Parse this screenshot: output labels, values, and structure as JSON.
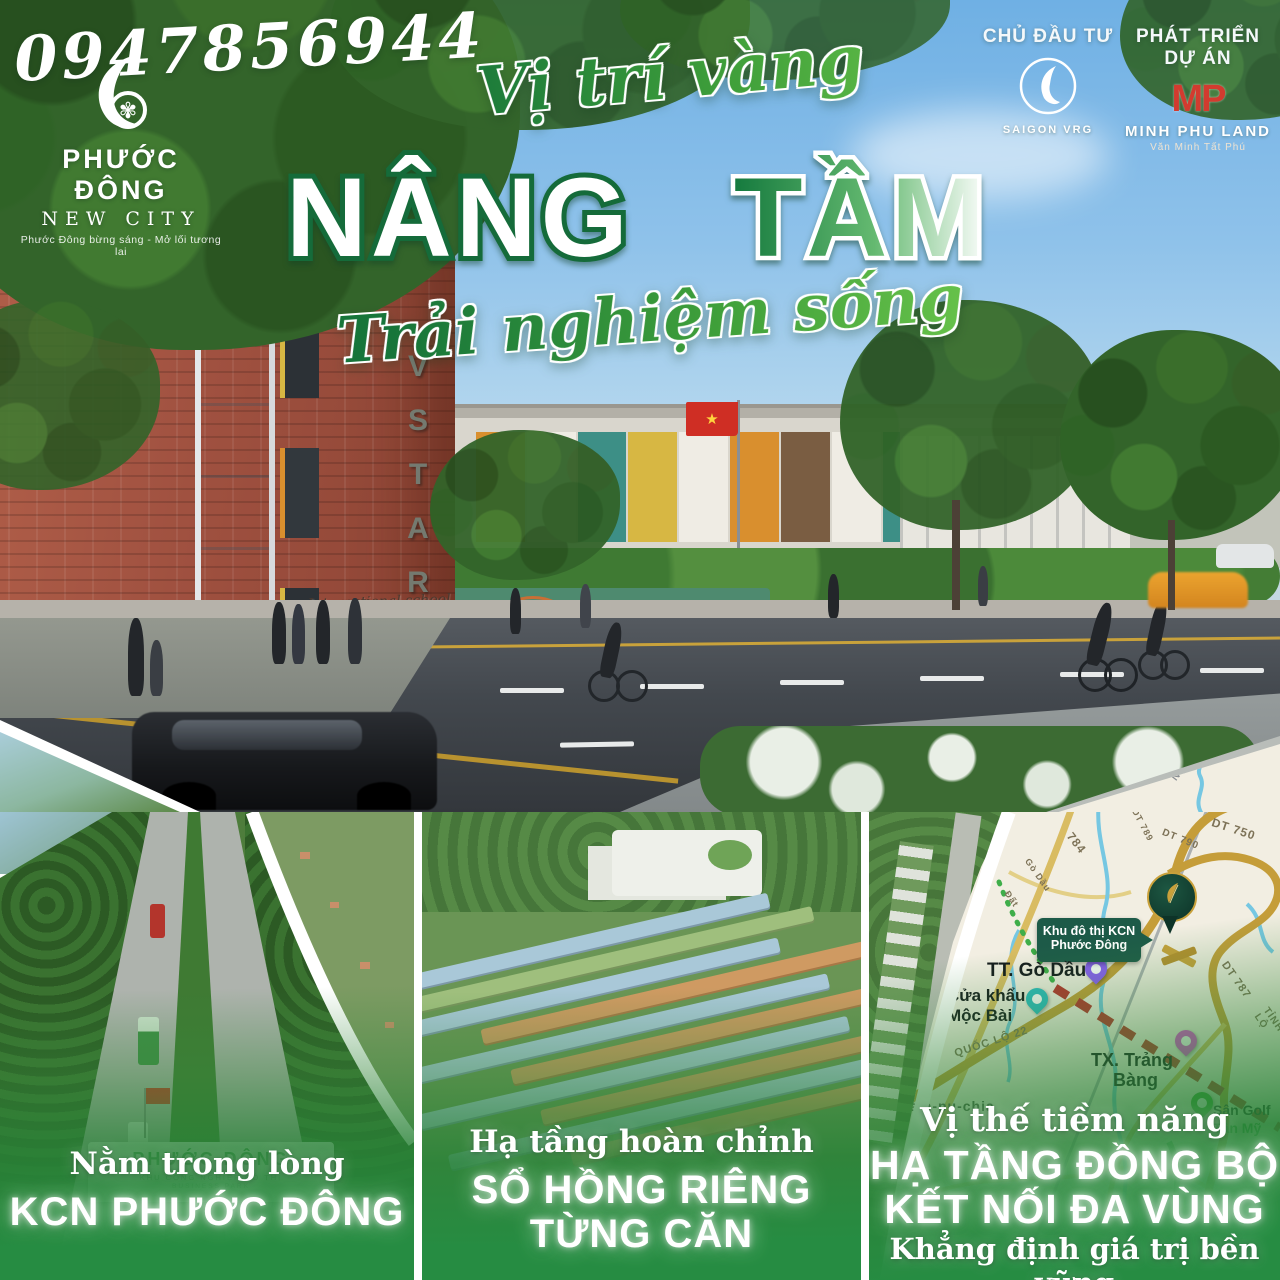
{
  "phone": "0947856944",
  "brand": {
    "name": "PHƯỚC ĐÔNG",
    "sub": "NEW CITY",
    "tagline": "Phước Đông bừng sáng - Mở lối tương lai"
  },
  "partners": {
    "investor_label": "CHỦ ĐẦU TƯ",
    "investor_name": "SAIGON VRG",
    "developer_label": "PHÁT TRIỂN DỰ ÁN",
    "developer_monogram": "MP",
    "developer_name": "MINH PHU LAND",
    "developer_tagline": "Văn Minh Tất Phú"
  },
  "headline": {
    "script_top": "Vị trí vàng",
    "word1": "NÂNG",
    "word2": "TẦM",
    "script_bottom": "Trải nghiệm sống"
  },
  "hero": {
    "school_sign_letters": [
      "V",
      "S",
      "T",
      "A",
      "R"
    ],
    "school_sign_sub": "International school",
    "library_sign": "LIBRARY"
  },
  "panel_left": {
    "gate_title": "PHƯỚC ĐÔNG",
    "gate_sub1": "KHU CÔNG NGHIỆP ĐÔ THỊ",
    "gate_sub2": "BUSINESS PARK",
    "caption1": "Nằm trong lòng",
    "caption2": "KCN PHƯỚC ĐÔNG"
  },
  "panel_middle": {
    "caption1": "Hạ tầng hoàn chỉnh",
    "caption2": "SỔ HỒNG RIÊNG",
    "caption3": "TỪNG CĂN"
  },
  "panel_right": {
    "caption1": "Vị thế tiềm năng",
    "caption2": "HẠ TẦNG ĐỒNG BỘ",
    "caption3": "KẾT NỐI ĐA VÙNG",
    "caption4": "Khẳng định giá trị bền vững"
  },
  "map": {
    "callout_line1": "Khu đô thị KCN",
    "callout_line2": "Phước Đông",
    "roads": {
      "r784": "784",
      "dt789": "DT 789",
      "dt790": "DT 790",
      "dt750": "DT 750",
      "dt787": "DT 787",
      "ql22": "QUỐC LỘ 22",
      "tinh_lo": "TỈNH LỘ",
      "noi": "NỘI",
      "go_dau_road": "Gò Dầu",
      "dat_road": "Đất"
    },
    "places": {
      "tt_go_dau": "TT. Gò Dầu",
      "cua_khau1": "Cửa khẩu",
      "cua_khau2": "Mộc Bài",
      "tx_trang1": "TX. Trảng",
      "tx_trang2": "Bàng",
      "campuchia": "Cam-pu-chia",
      "san_golf": "Sân Golf",
      "tan_my": "Tân Mỹ"
    }
  },
  "colors": {
    "headline_green": "#156b3a",
    "accent_gold": "#c9a13b",
    "overlay_green": "#268c42",
    "callout_green": "#1d5a48",
    "pin_purple": "#8b5cf6",
    "pin_teal": "#2bbcc0",
    "pin_magenta": "#e649d8",
    "pin_green": "#37a832",
    "brand_red": "#d23b2f"
  }
}
